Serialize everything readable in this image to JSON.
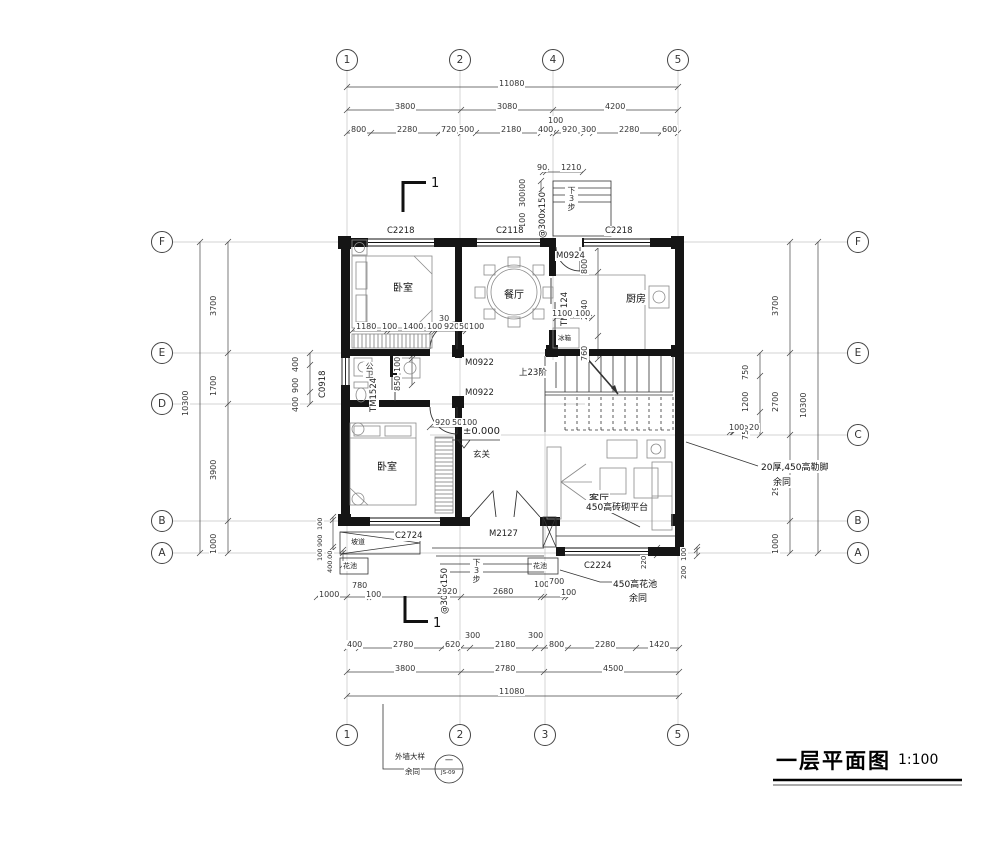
{
  "title": {
    "name": "一层平面图",
    "scale": "1:100"
  },
  "grid": {
    "top": [
      "1",
      "2",
      "4",
      "5"
    ],
    "bottom": [
      "1",
      "2",
      "3",
      "5"
    ],
    "left": [
      "F",
      "E",
      "D",
      "B",
      "A"
    ],
    "right": [
      "F",
      "E",
      "C",
      "B",
      "A"
    ]
  },
  "rooms": {
    "bedroom_top": "卧室",
    "dining": "餐厅",
    "kitchen": "厨房",
    "bath": "公卫",
    "bedroom_bottom": "卧室",
    "foyer": "玄关",
    "living": "客厅"
  },
  "windows": {
    "top_left": "C2218",
    "top_mid": "C2118",
    "top_right": "C2218",
    "left": "C0918",
    "bottom_left": "C2724",
    "bottom_right": "C2224"
  },
  "doors": {
    "rear": "M0924",
    "kitchen_slide": "TM2124",
    "bath_slide": "TM1524",
    "bedroom_top": "M0922",
    "bedroom_bottom": "M0922",
    "entry": "M2127"
  },
  "notes": {
    "stair": "上23阶",
    "level": "±0.000",
    "steps": "@300x150",
    "steps_dir": "下3步",
    "plinth": "20厚,450高勒脚",
    "same": "余同",
    "platform": "450高砖砌平台",
    "flower_big": "450高花池",
    "flower": "花池",
    "ramp": "坡道",
    "fridge": "冰箱",
    "section": "1",
    "detail_t1": "外墙大样",
    "detail_top": "一",
    "detail_no": "JS-09"
  },
  "dims": {
    "top_total": "11080",
    "top_major": [
      "3800",
      "3080",
      "4200"
    ],
    "top_minor": [
      "800",
      "2280",
      "720",
      "500",
      "2180",
      "400",
      "100",
      "920",
      "300",
      "2280",
      "600"
    ],
    "rear_steps": [
      "90",
      "1210",
      "300",
      "300",
      "1100"
    ],
    "kitchen": [
      "800",
      "2140",
      "760",
      "1100",
      "100"
    ],
    "bed1_chain": [
      "1180",
      "100",
      "1400",
      "100",
      "920",
      "50",
      "100",
      "30"
    ],
    "bath": [
      "100",
      "850"
    ],
    "door2_chain": [
      "920",
      "50",
      "100"
    ],
    "left_outer": "10300",
    "left_major": [
      "3700",
      "1700",
      "3900",
      "1000"
    ],
    "left_sub": [
      "400",
      "900",
      "400"
    ],
    "left_small": [
      "100",
      "900",
      "100",
      "100",
      "400"
    ],
    "right_outer": "10300",
    "right_major": [
      "3700",
      "2700",
      "2900",
      "1000"
    ],
    "right_sub": [
      "750",
      "1200",
      "750"
    ],
    "right_small": [
      "100",
      "20",
      "100",
      "200",
      "220"
    ],
    "bottom_r1": [
      "1000",
      "780",
      "100",
      "2920",
      "2680",
      "100",
      "700",
      "100"
    ],
    "bottom_r2": [
      "400",
      "2780",
      "620",
      "300",
      "2180",
      "300",
      "800",
      "2280",
      "1420"
    ],
    "bottom_major": [
      "3800",
      "2780",
      "4500"
    ],
    "bottom_total": "11080"
  }
}
